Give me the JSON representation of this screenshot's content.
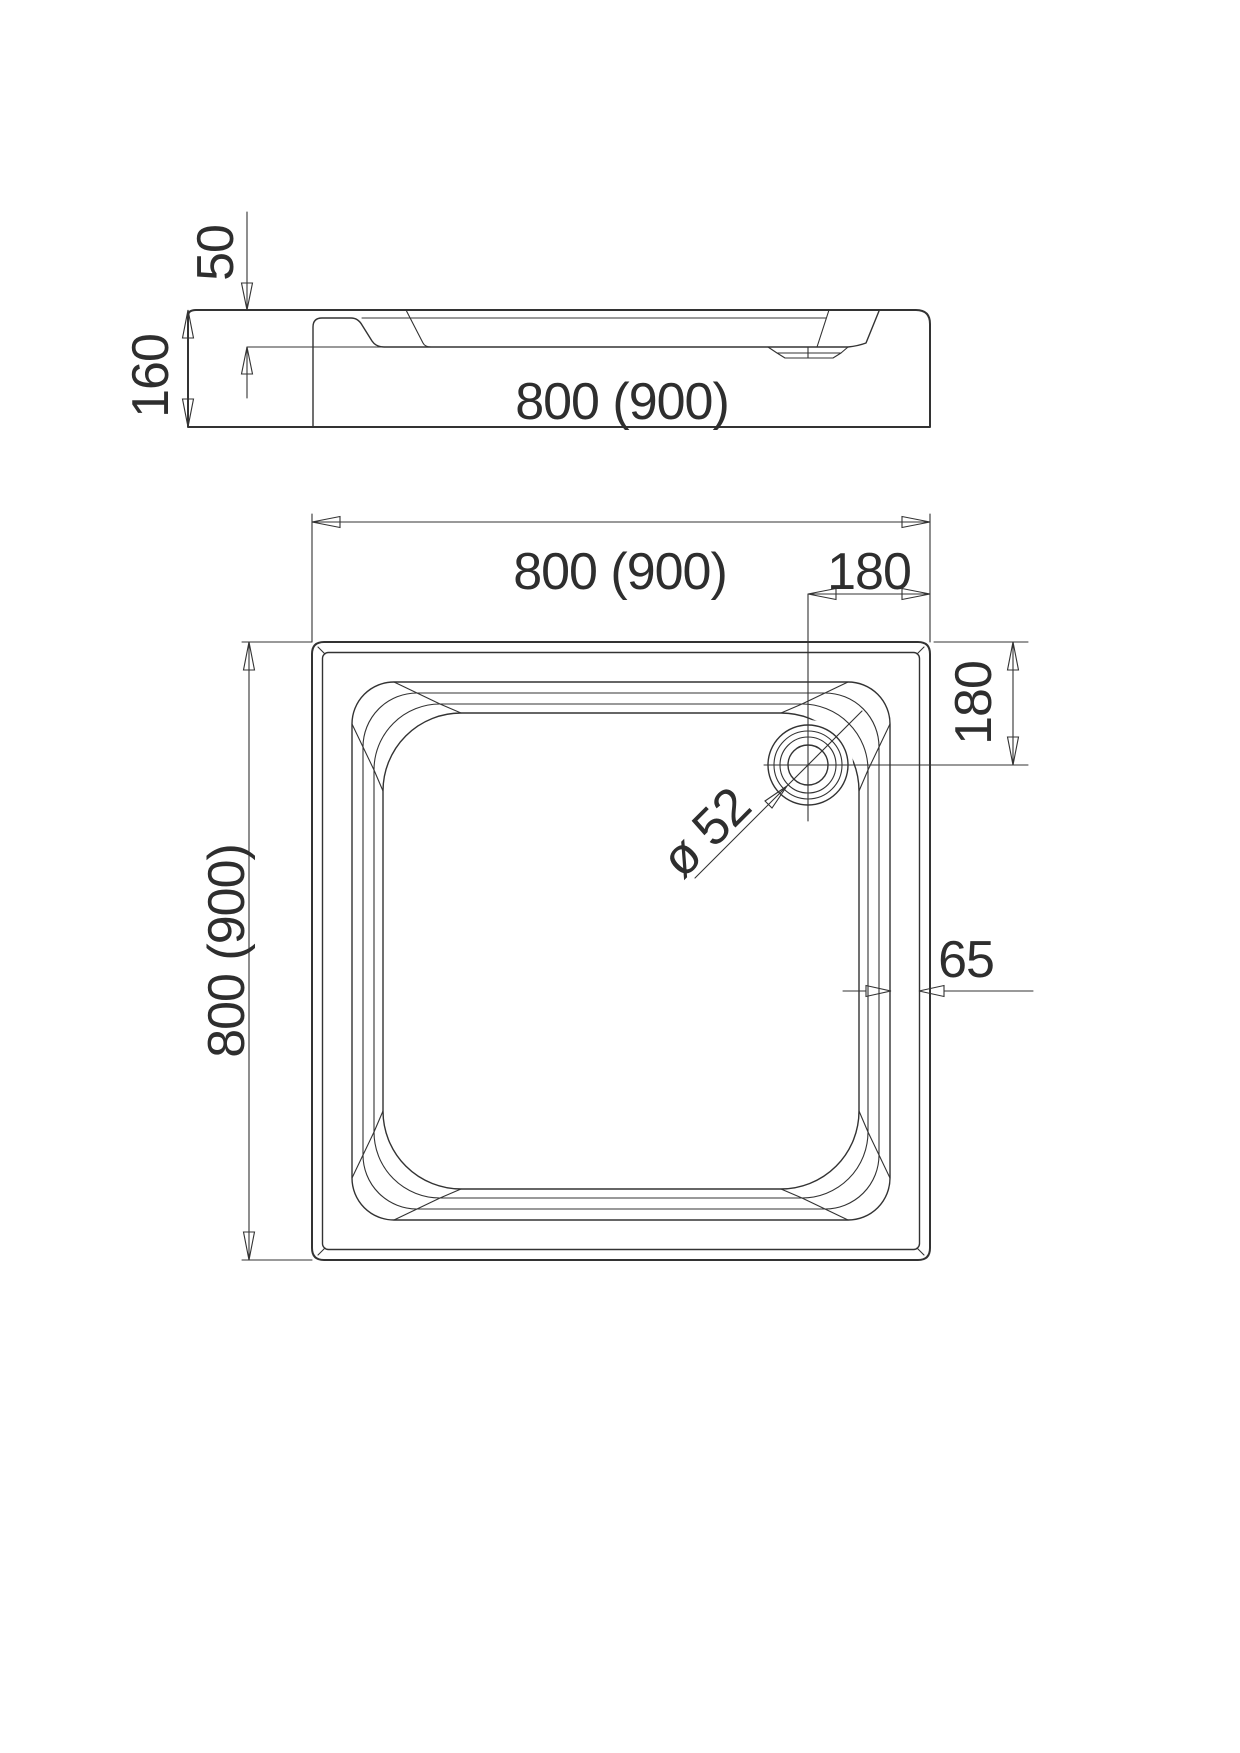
{
  "drawing": {
    "type": "shower-tray technical drawing",
    "background_color": "#ffffff",
    "line_color": "#333333",
    "text_color": "#2e2e2e",
    "side_view": {
      "overall_height": "160",
      "rim_to_floor_depth": "50",
      "overall_width": "800 (900)"
    },
    "plan_view": {
      "overall_width": "800 (900)",
      "overall_height": "800 (900)",
      "drain_offset_from_right": "180",
      "drain_offset_from_top": "180",
      "drain_diameter": "ø 52",
      "wall_step_width": "65"
    }
  }
}
